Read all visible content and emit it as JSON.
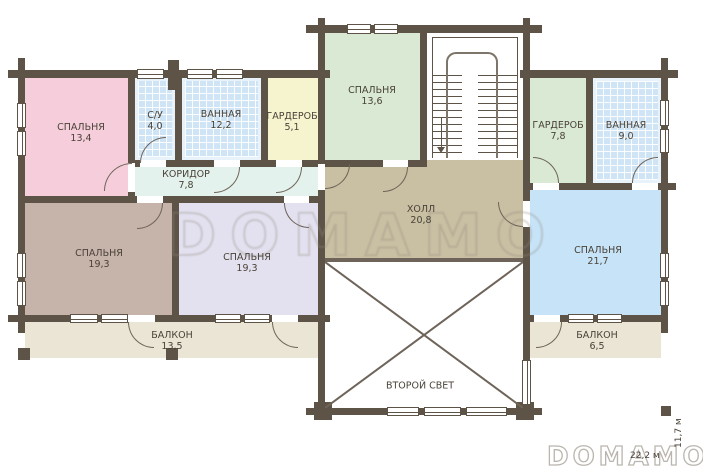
{
  "plan": {
    "title": "floor-plan-second-floor",
    "watermark": "DOMAMO",
    "logo": "DOMAMO",
    "dimensions": {
      "width_label": "22,2 м",
      "height_label": "11,7 м"
    },
    "rooms": [
      {
        "id": "bedroom-1",
        "name": "СПАЛЬНЯ",
        "area": "13,4"
      },
      {
        "id": "wc",
        "name": "С/У",
        "area": "4,0"
      },
      {
        "id": "bathroom-1",
        "name": "ВАННАЯ",
        "area": "12,2"
      },
      {
        "id": "wardrobe-1",
        "name": "ГАРДЕРОБ",
        "area": "5,1"
      },
      {
        "id": "bedroom-2",
        "name": "СПАЛЬНЯ",
        "area": "13,6"
      },
      {
        "id": "wardrobe-2",
        "name": "ГАРДЕРОБ",
        "area": "7,8"
      },
      {
        "id": "bathroom-2",
        "name": "ВАННАЯ",
        "area": "9,0"
      },
      {
        "id": "corridor",
        "name": "КОРИДОР",
        "area": "7,8"
      },
      {
        "id": "hall",
        "name": "ХОЛЛ",
        "area": "20,8"
      },
      {
        "id": "bedroom-3",
        "name": "СПАЛЬНЯ",
        "area": "19,3"
      },
      {
        "id": "bedroom-4",
        "name": "СПАЛЬНЯ",
        "area": "19,3"
      },
      {
        "id": "bedroom-5",
        "name": "СПАЛЬНЯ",
        "area": "21,7"
      },
      {
        "id": "balcony-1",
        "name": "БАЛКОН",
        "area": "13,5"
      },
      {
        "id": "balcony-2",
        "name": "БАЛКОН",
        "area": "6,5"
      },
      {
        "id": "void",
        "name": "ВТОРОЙ СВЕТ",
        "area": ""
      }
    ],
    "colors": {
      "wall": "#5d5347",
      "label_text": "#4a4238",
      "bedroom_pink": "#f6cedb",
      "bedroom_green": "#d9e9d3",
      "bedroom_taupe": "#c6b3aa",
      "bedroom_lavender": "#e3e1f0",
      "bedroom_blue": "#c6e3f7",
      "wardrobe_yellow": "#f6f3cf",
      "tile_blue": "#cfe4f4",
      "corridor_mint": "#e3f2ec",
      "hall_tan": "#c9bfa3",
      "balcony_beige": "#ebe5d6"
    }
  }
}
